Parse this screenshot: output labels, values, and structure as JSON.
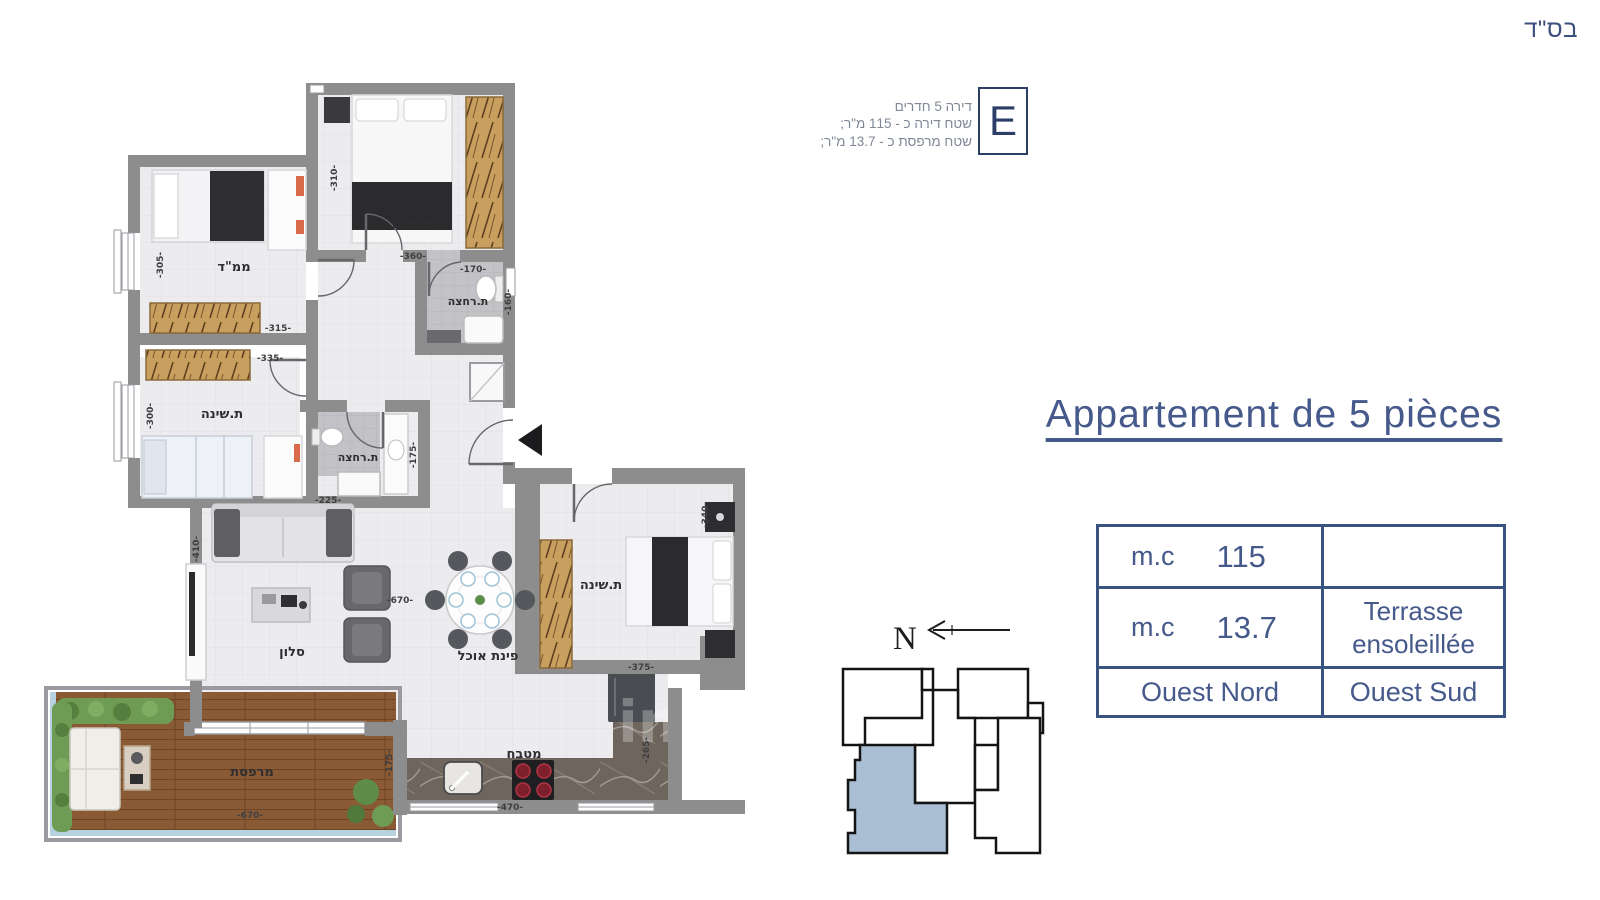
{
  "header": {
    "bsd": "בס\"ד"
  },
  "unit_info": {
    "letter": "E",
    "line1": "דירה 5 חדרים",
    "line2": "שטח דירה כ - 115 מ\"ר;",
    "line3": "שטח מרפסת כ - 13.7 מ\"ר;"
  },
  "title": "Appartement de 5 pièces",
  "spec_table": {
    "r1c1_label": "m.c",
    "r1c1_value": "115",
    "r1c2": "",
    "r2c1_label": "m.c",
    "r2c1_value": "13.7",
    "r2c2_line1": "Terrasse",
    "r2c2_line2": "ensoleillée",
    "r3c1": "Ouest Nord",
    "r3c2": "Ouest Sud"
  },
  "compass": {
    "north": "N"
  },
  "floorplan": {
    "watermark": "im",
    "rooms": {
      "bedroom_top": "ת.שינה",
      "mamad": "ממ\"ד",
      "bathroom_top": "ת.רחצה",
      "bedroom_left": "ת.שינה",
      "bathroom_mid": "ת.רחצה",
      "living": "סלון",
      "dining": "פינת אוכל",
      "bedroom_right": "ת.שינה",
      "kitchen": "מטבח",
      "terrace": "מרפסת"
    },
    "dims": {
      "top_bedroom_h": "-310-",
      "top_bedroom_w": "-360-",
      "mamad_h": "-305-",
      "mamad_w": "-315-",
      "bedroom_left_w": "-335-",
      "bedroom_left_h": "-300-",
      "bath_top_w": "-170-",
      "bath_top_h": "-160-",
      "bath_mid_w": "-225-",
      "bath_mid_h": "-175-",
      "living_h": "-410-",
      "living_w": "-670-",
      "bedroom_right_h": "-340-",
      "bedroom_right_w": "-375-",
      "terrace_w": "-670-",
      "terrace_h": "-175-",
      "kitchen_w": "-470-",
      "kitchen_h": "-265-"
    }
  },
  "colors": {
    "accent_blue": "#46598b",
    "table_border": "#3a5280",
    "info_gray": "#7e8796",
    "wall_gray": "#8d8d8d",
    "minimap_highlight": "#a9bed3"
  }
}
